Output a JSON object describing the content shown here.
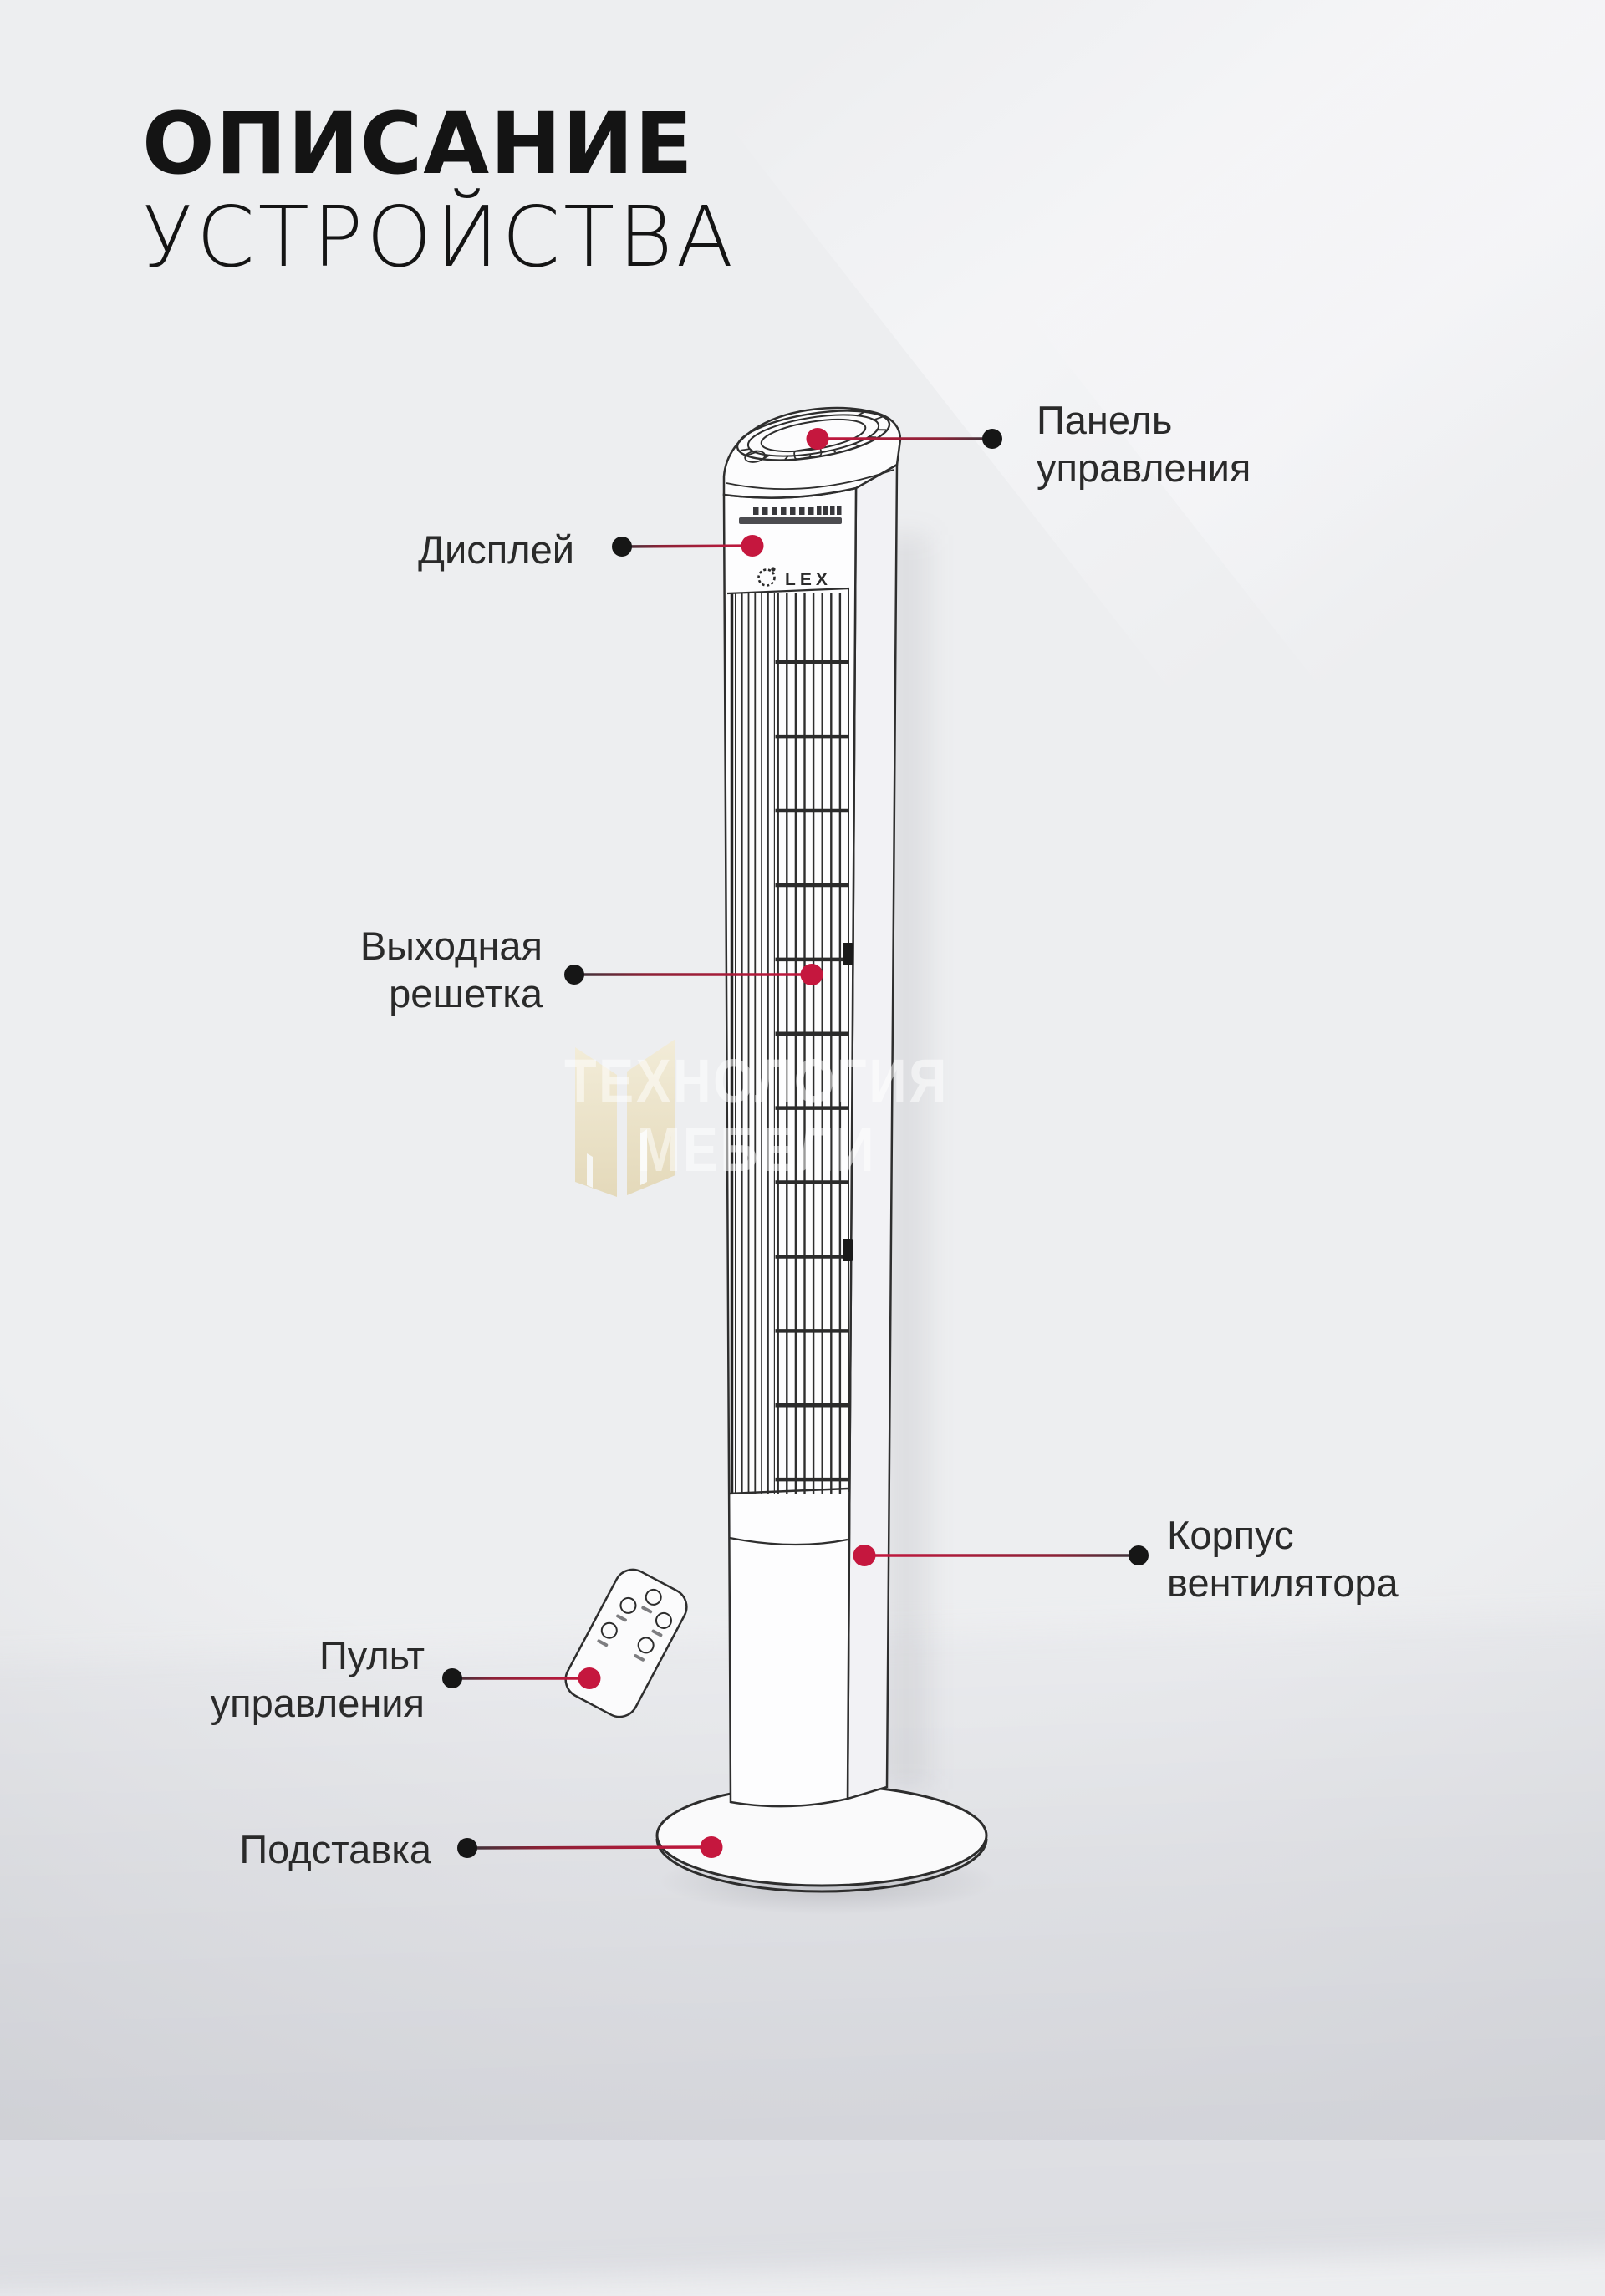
{
  "title": {
    "line1": "ОПИСАНИЕ",
    "line2": "УСТРОЙСТВА"
  },
  "brand": {
    "logo_text": "LEX"
  },
  "watermark": {
    "line1": "ТЕХНОЛОГИЯ",
    "line2": "МЕБЕЛИ"
  },
  "callouts": {
    "control_panel": {
      "label": "Панель\nуправления"
    },
    "display": {
      "label": "Дисплей"
    },
    "outlet_grille": {
      "label": "Выходная\nрешетка"
    },
    "fan_body": {
      "label": "Корпус\nвентилятора"
    },
    "remote": {
      "label": "Пульт\nуправления"
    },
    "stand": {
      "label": "Подставка"
    }
  },
  "colors": {
    "accent": "#c5173e",
    "dot_black": "#161616",
    "label_text": "#2a2a2a",
    "title_text": "#141414",
    "background": "#edeef0",
    "watermark_logo": "#eadfc3",
    "line_dark": "#38343a",
    "drawing_stroke": "#2e2e2e"
  }
}
